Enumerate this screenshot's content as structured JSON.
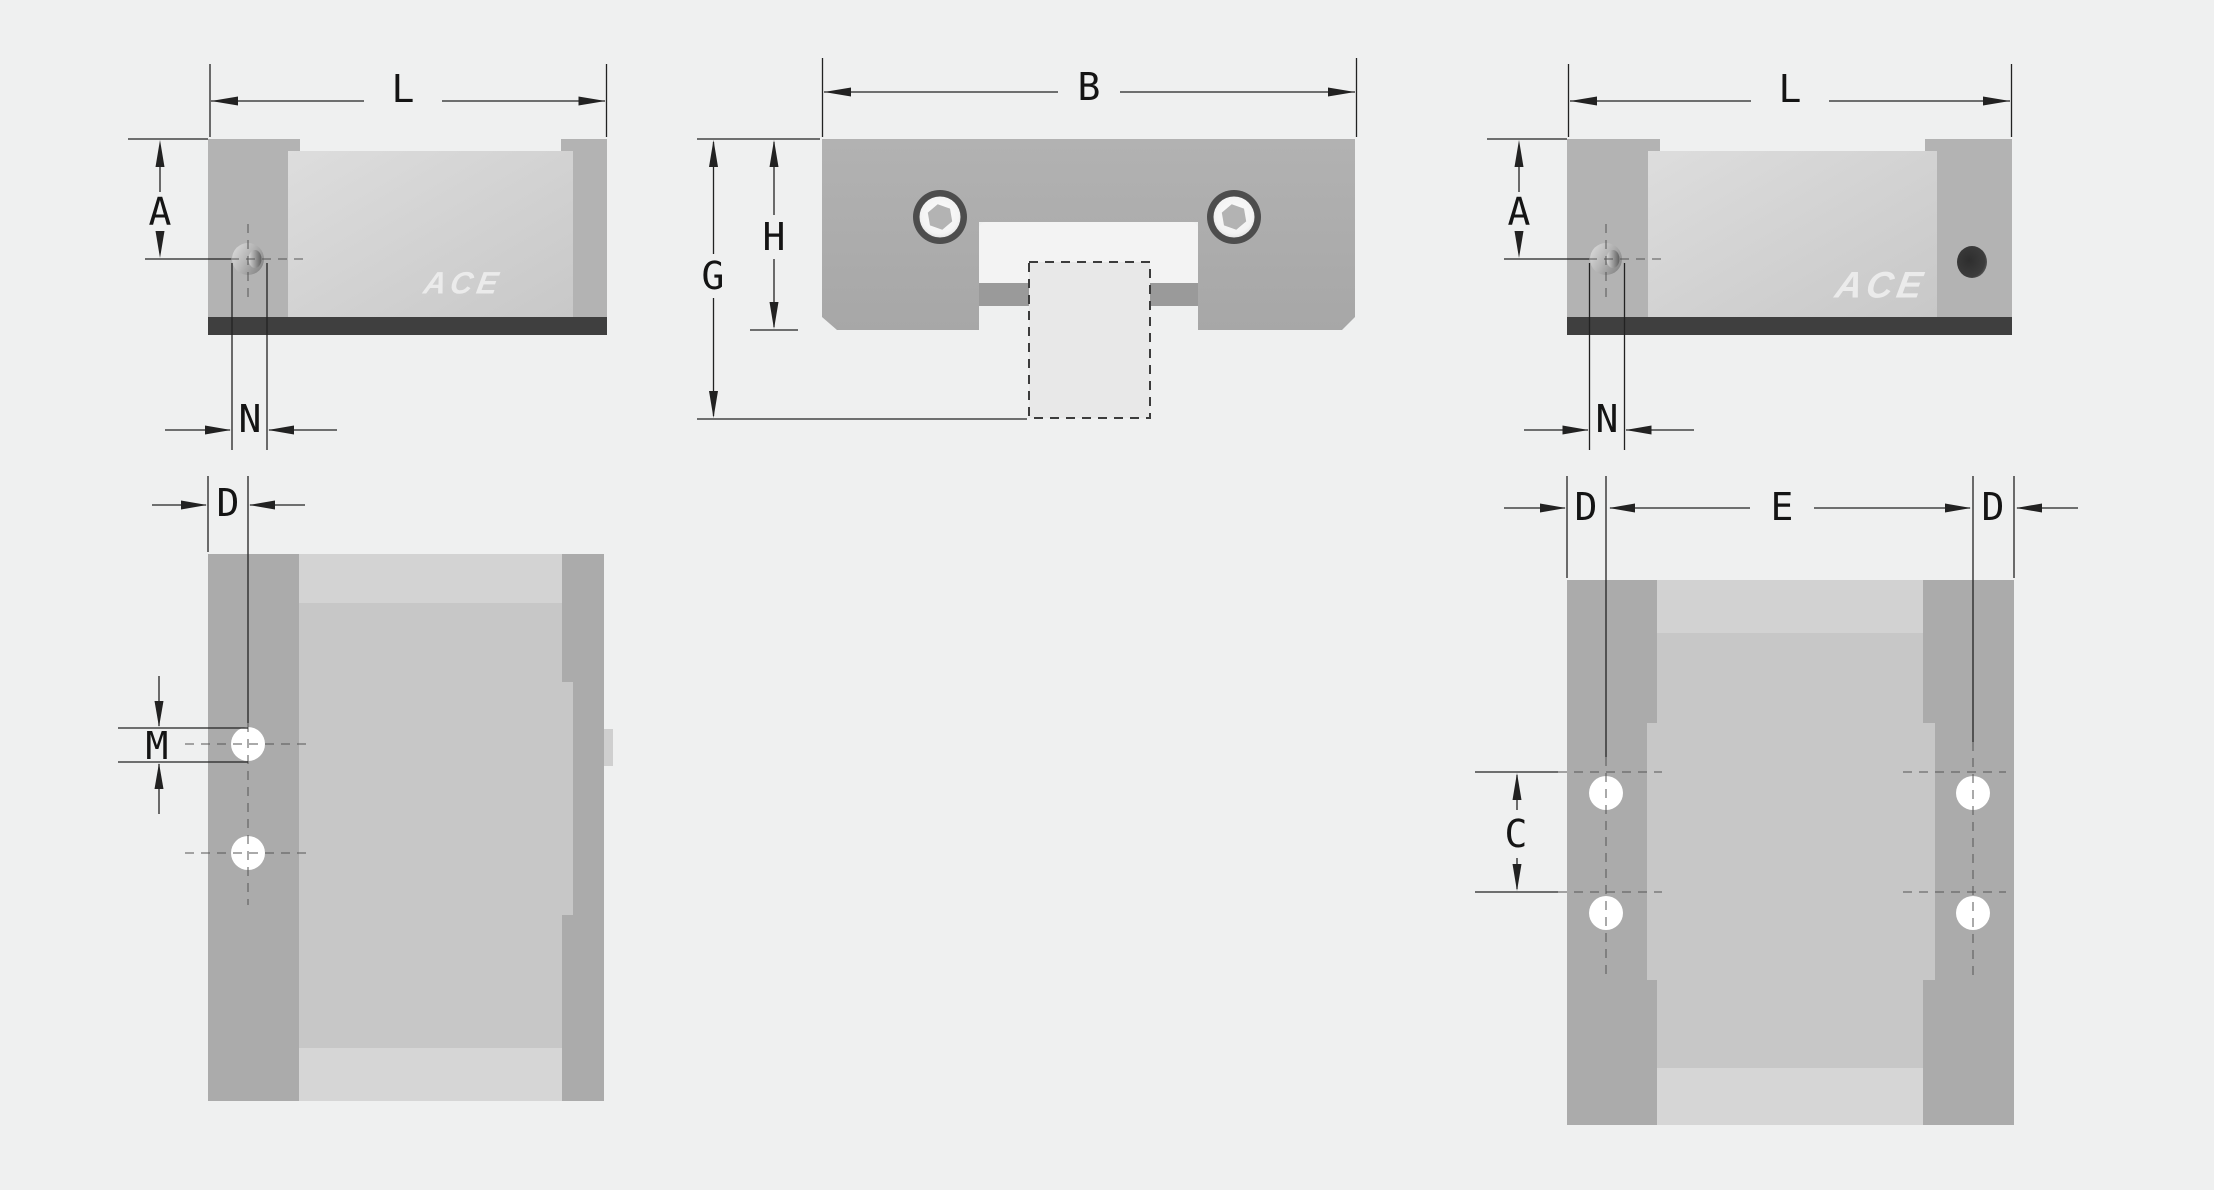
{
  "drawing": {
    "type": "technical-dimension-drawing",
    "subject": "linear guide rail carriage block, five orthographic views",
    "brand_watermark": "ACE"
  },
  "views": {
    "side_left": {
      "dim_length": "L",
      "dim_hole_height": "A",
      "dim_hole_offset": "N",
      "watermark": "ACE"
    },
    "front": {
      "dim_width": "B",
      "dim_overall_height": "G",
      "dim_body_height": "H"
    },
    "side_right": {
      "dim_length": "L",
      "dim_hole_height": "A",
      "dim_hole_offset": "N",
      "watermark": "ACE"
    },
    "top_left": {
      "dim_edge_to_hole": "D",
      "dim_hole_diameter": "M"
    },
    "top_right": {
      "dim_edge_to_hole_left": "D",
      "dim_hole_span": "E",
      "dim_edge_to_hole_right": "D",
      "dim_hole_pitch": "C"
    }
  },
  "colors": {
    "background": "#eff0f0",
    "body_gray": "#adadad",
    "panel_light": "#d6d6d6",
    "seal_strip_dark": "#3f3f3f",
    "recess_bar": "#9a9a9a",
    "rail_fill": "#e8e8e8",
    "hole_white": "#ffffff",
    "screw_ring": "#4d4d4d",
    "dimension_line": "#222222",
    "watermark": "#ebebeb"
  }
}
